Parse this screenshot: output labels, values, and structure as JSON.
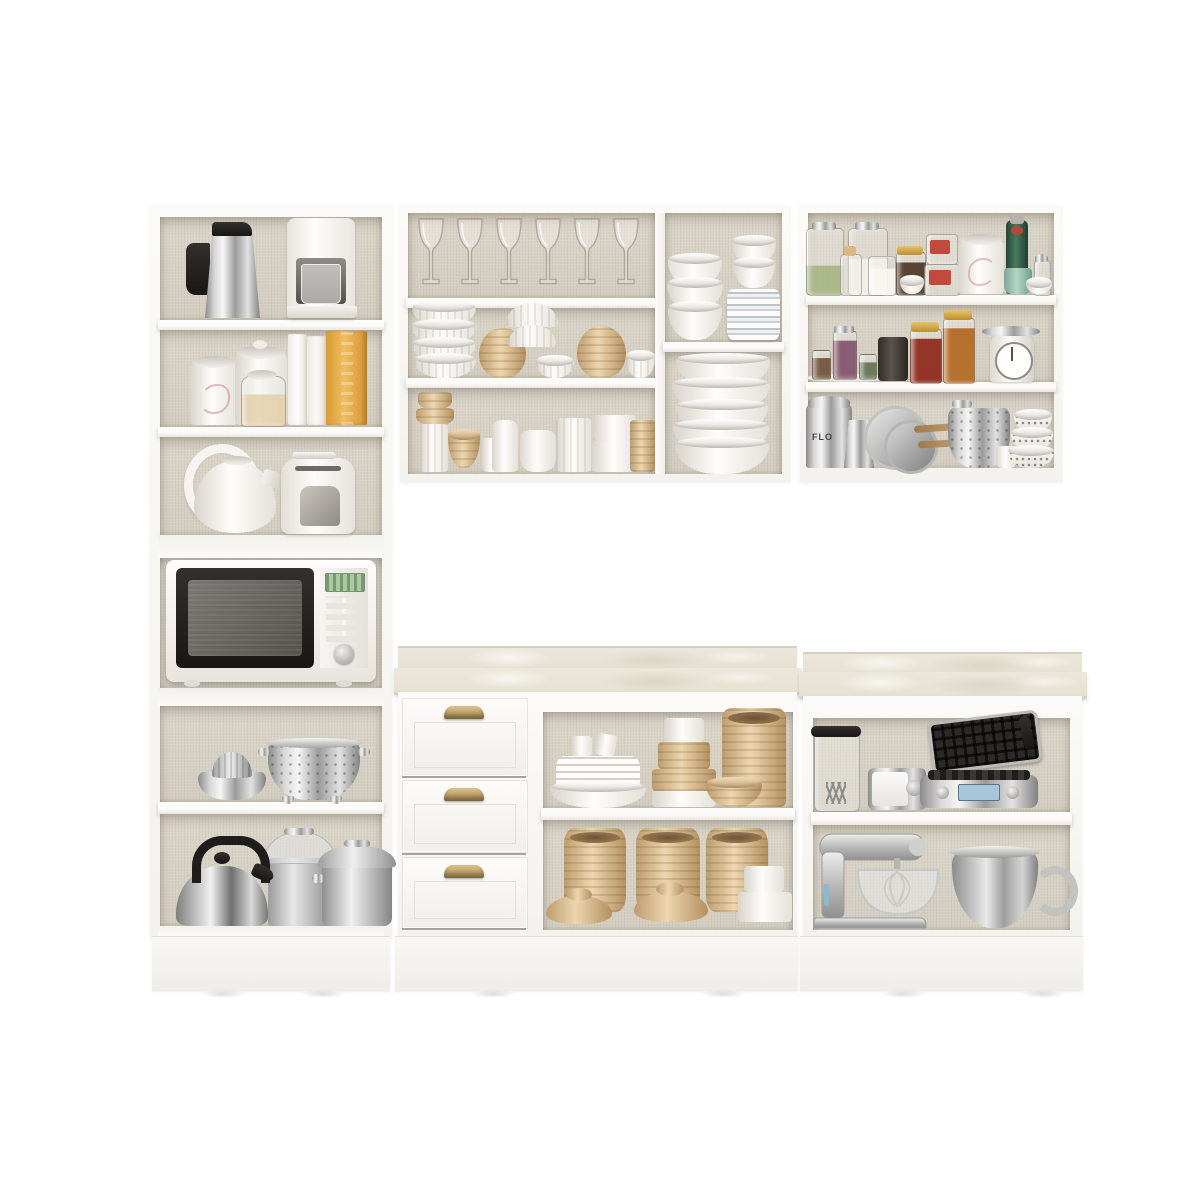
{
  "meta": {
    "description": "Product photograph of a white modular kitchen cabinet set with open shelves and drawers, fully styled with kitchenware, appliances and pantry jars on a plain white background."
  },
  "labels": {
    "flour_tin": "FLO"
  },
  "colors": {
    "cabWhite": "#f8f7f4",
    "interiorBeige": "#d8d2c6",
    "counterMarble": "#eae5d7",
    "tan": "#d9bc93",
    "brass": "#c2a067",
    "steel": "#bdbdbd",
    "applianceBlack": "#1d1c1a",
    "bottleGreen": "#315c47",
    "jamRed": "#99301c",
    "honeyAmber": "#b4691f",
    "tealCup": "#93c0ae",
    "displayGreen": "#a9cba2",
    "waffleDisplayBlue": "#a6c6da",
    "bookGold": "#e2a845",
    "plateBlue": "#b9c3ca"
  },
  "inventory": {
    "upper_left_cabinet": [
      "stainless french press / moka pot",
      "white drip coffee machine",
      "white floral canister",
      "white lidded jar",
      "glass jar with grains",
      "two white books",
      "gold patterned book",
      "white decorative loop",
      "white tea kettle",
      "white toaster",
      "microwave oven with black door and green display"
    ],
    "upper_middle_cabinet": [
      "six wine glasses",
      "stack of white ribbed bowls",
      "two tan round vases",
      "upside-down white bowls",
      "small white bowls",
      "assorted white and tan cups and canisters",
      "stack of white bowls",
      "small bowls on stacked white and blue plates",
      "large stack of white mixing bowls"
    ],
    "upper_right_cabinet": [
      "clamp jars with herbs and salt",
      "corked bottle",
      "jar of coffee beans with gold lid",
      "stacked jars with red labels",
      "white floral canister",
      "green glass bottle",
      "teal cup",
      "glass sugar dispenser",
      "tray of spice jars",
      "dark canister",
      "red jam jar",
      "amber honey jar",
      "retro kitchen scale",
      "flour tin",
      "moka pot",
      "pans with wooden handles",
      "mesh colander pot",
      "stack of patterned bowls",
      "white cup"
    ],
    "base_middle_cabinet": [
      "three drawers with brass cup pulls",
      "stack of white plates with two cups",
      "tiered round boxes",
      "tall tan ribbed canister",
      "small tan bowl",
      "three tan ribbed canisters with dome lids",
      "stacked white round boxes"
    ],
    "base_right_cabinet": [
      "glass blender jug with black lid",
      "small silver appliance with knob",
      "open waffle maker with blue display",
      "silver stand mixer with glass bowl and whisk",
      "large stainless mixing bowl"
    ]
  }
}
